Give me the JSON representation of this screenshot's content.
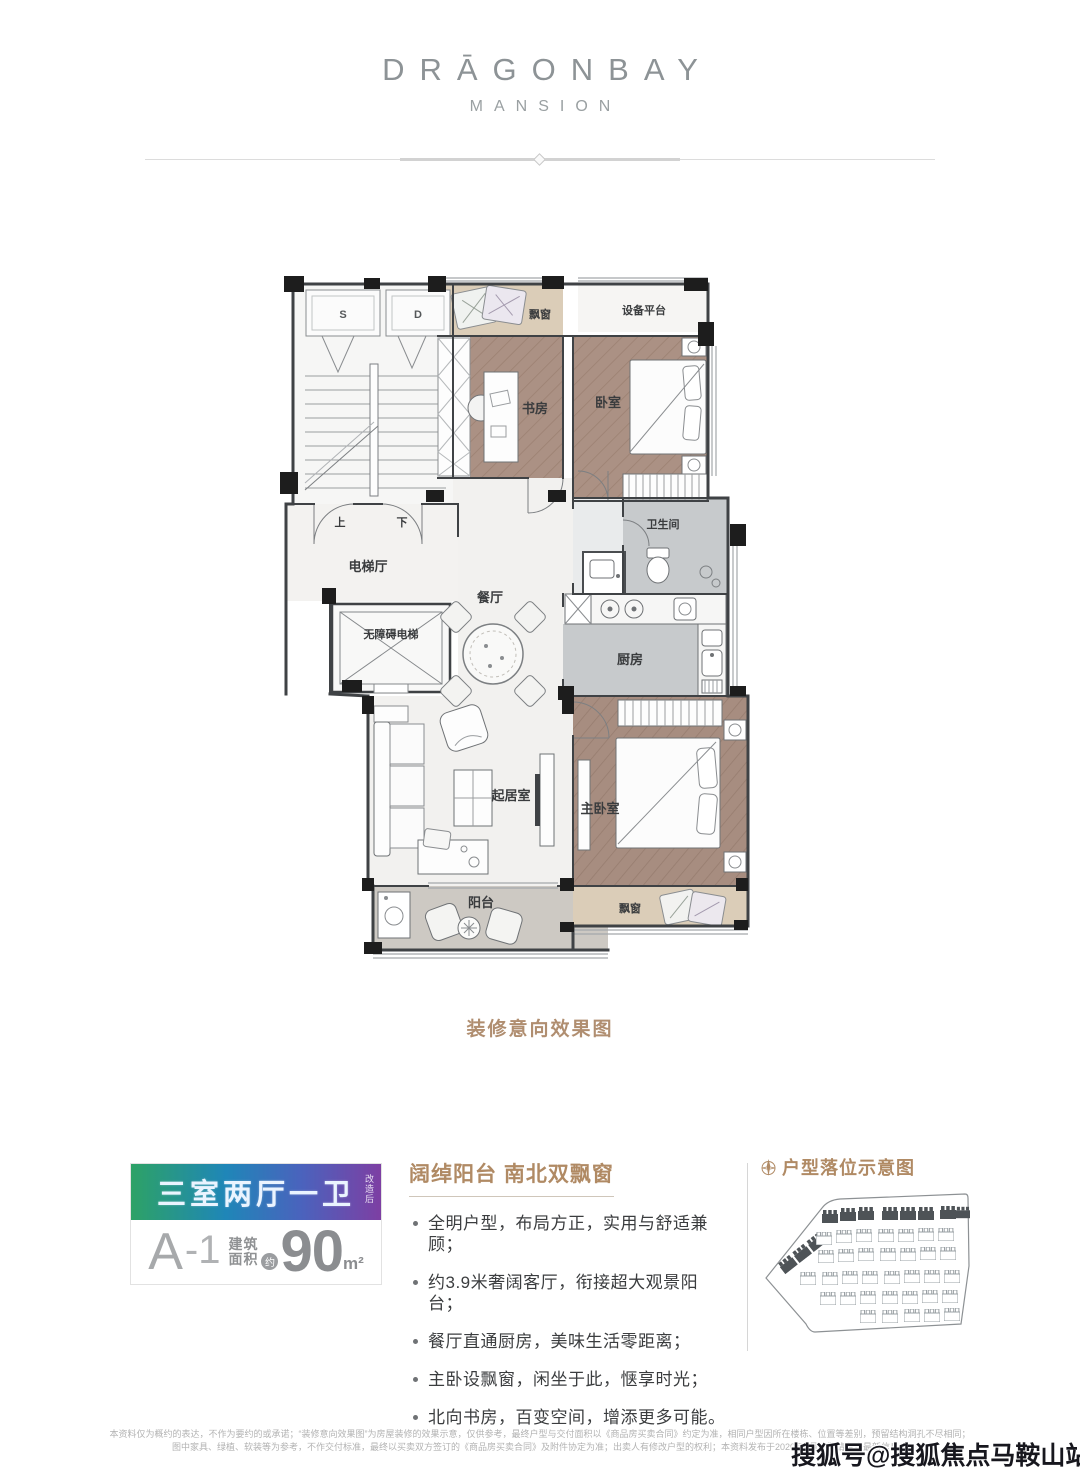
{
  "brand": {
    "line1": "DRĀGONBAY",
    "line2": "MANSION"
  },
  "floorplan": {
    "caption": "装修意向效果图",
    "labels": {
      "closet_s": "S",
      "closet_d": "D",
      "up": "上",
      "down": "下",
      "elevator_hall": "电梯厅",
      "accessible_elevator": "无障碍电梯",
      "bay_window_top": "飘窗",
      "equipment_platform": "设备平台",
      "study": "书房",
      "bedroom": "卧室",
      "bathroom": "卫生间",
      "kitchen": "厨房",
      "dining": "餐厅",
      "living": "起居室",
      "master_bedroom": "主卧室",
      "balcony": "阳台",
      "bay_window_bottom": "飘窗"
    }
  },
  "unit_card": {
    "type_label": "三室两厅一卫",
    "type_note": "改造后",
    "unit_code": "A",
    "unit_dash": "-1",
    "area_prefix_1": "建筑",
    "area_prefix_2": "面积",
    "approx": "约",
    "area_value": "90",
    "area_unit": "m²",
    "gradient_colors": [
      "#2da266",
      "#1f86b8",
      "#4a63bd",
      "#7d3fa3"
    ]
  },
  "features": {
    "heading": "阔绰阳台 南北双飘窗",
    "bullets": [
      "全明户型，布局方正，实用与舒适兼顾；",
      "约3.9米奢阔客厅，衔接超大观景阳台；",
      "餐厅直通厨房，美味生活零距离；",
      "主卧设飘窗，闲坐于此，惬享时光；",
      "北向书房，百变空间，增添更多可能。"
    ]
  },
  "siteplan": {
    "heading": "户型落位示意图"
  },
  "disclaimer": {
    "line1": "本资料仅为概约的表达，不作为要约的或承诺；“装修意向效果图”为房屋装修的效果示意，仅供参考，最终户型与交付面积以《商品房买卖合同》约定为准，相同户型因所在楼栋、位置等差别，预留结构洞孔不尽相同；",
    "line2": "图中家具、绿植、软装等为参考，不作交付标准，最终以买卖双方签订的《商品房买卖合同》及附件协定为准；出卖人有修改户型的权利；本资料发布于2020年7月，敬请留意最新信息。"
  },
  "watermark": "搜狐号@搜狐焦点马鞍山站",
  "accent_color": "#b08a64"
}
